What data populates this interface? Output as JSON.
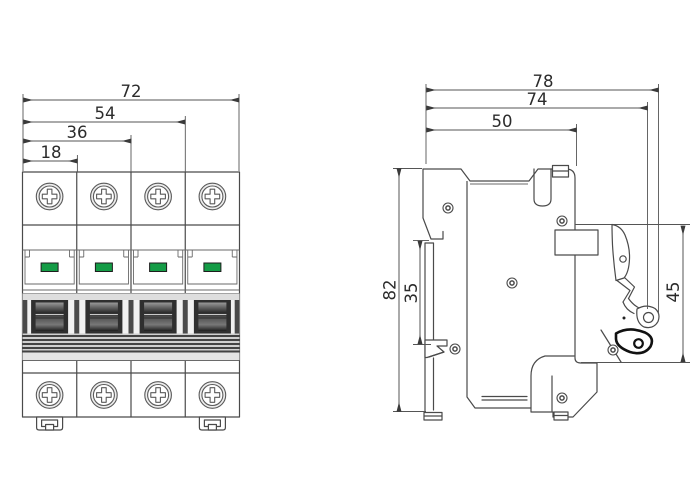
{
  "drawing": {
    "type": "technical-dimension-drawing",
    "subject": "4-pole miniature circuit breaker, front and side views"
  },
  "front_view": {
    "dim_labels": {
      "w_total": "72",
      "w_3pole": "54",
      "w_2pole": "36",
      "w_1pole": "18"
    },
    "pole_count": 4,
    "icons": [
      "terminal-screw-icon",
      "status-indicator-window",
      "toggle-handle",
      "din-clip"
    ]
  },
  "side_view": {
    "dim_labels": {
      "d_total": "78",
      "d_body": "74",
      "d_face": "50",
      "h_total": "82",
      "h_din_slot": "35",
      "h_front": "45"
    },
    "icons": [
      "rivet-icon",
      "toggle-lever",
      "lever-grip",
      "din-rail-clip",
      "top-tab"
    ]
  },
  "colors": {
    "outline": "#4a4a4a",
    "dimension": "#555555",
    "text": "#2b2b2b",
    "indicator_green": "#149c46",
    "toggle_dark": "#2f2f2f",
    "grip_black": "#111111"
  }
}
